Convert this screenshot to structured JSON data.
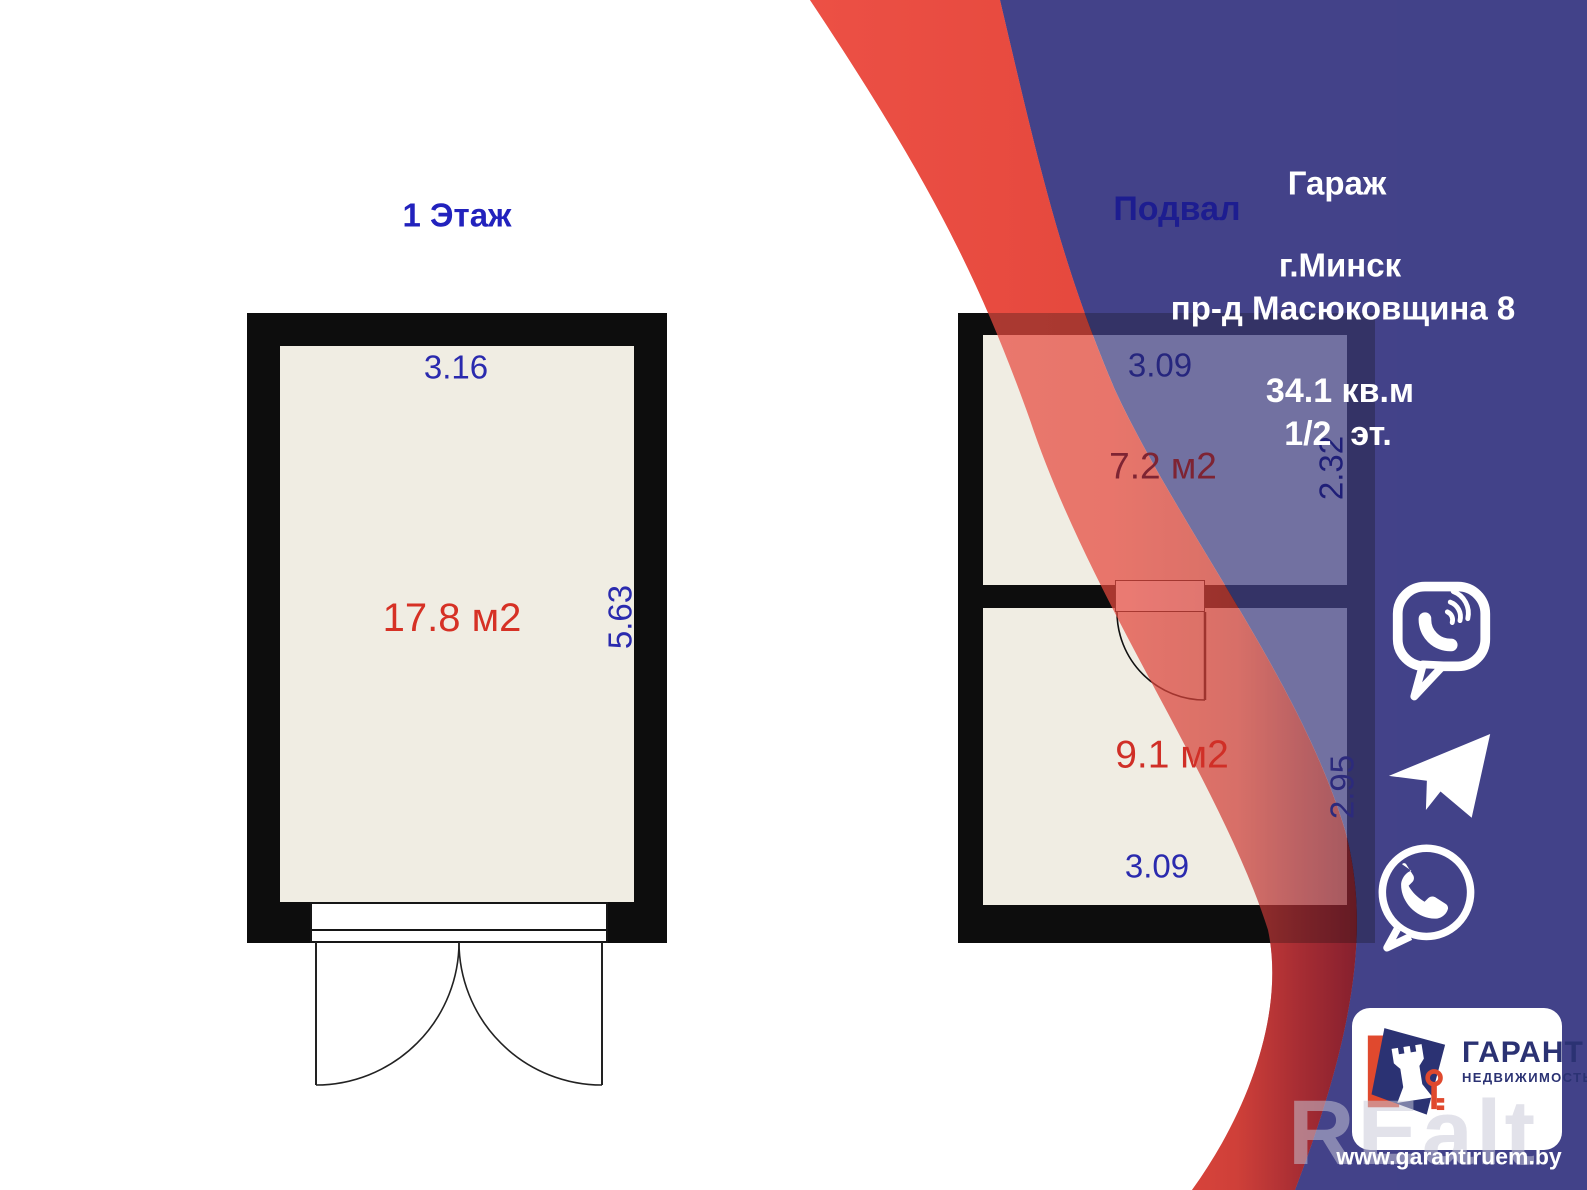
{
  "floor1": {
    "title": "1 Этаж",
    "top_dim": "3.16",
    "side_dim": "5.63",
    "area": "17.8 м2"
  },
  "basement": {
    "title": "Подвал",
    "room_top": {
      "area": "7.2 м2",
      "top_dim": "3.09",
      "side_dim": "2.32"
    },
    "room_bottom": {
      "area": "9.1 м2",
      "bottom_dim": "3.09",
      "side_dim": "2.95"
    }
  },
  "listing": {
    "property_type": "Гараж",
    "city": "г.Минск",
    "address": "пр-д Масюковщина 8",
    "total_area": "34.1 кв.м",
    "floor": "1/2  эт."
  },
  "branding": {
    "agency": "ГАРАНТ",
    "agency_sub": "НЕДВИЖИМОСТЬ",
    "website": "www.garantiruem.by",
    "watermark": "REalt"
  },
  "contact_icons": {
    "viber": "viber-icon",
    "telegram": "telegram-icon",
    "whatsapp": "whatsapp-icon"
  },
  "colors": {
    "swoosh_red": "#E84A3E",
    "swoosh_red_dark": "#86202E",
    "swoosh_blue": "#434289",
    "wall": "#0D0D0D",
    "room_fill": "#F0EDE3",
    "dim_blue": "#2A2AAE",
    "area_red": "#D63125",
    "logo_navy": "#2B3273",
    "logo_red": "#E0492E"
  }
}
